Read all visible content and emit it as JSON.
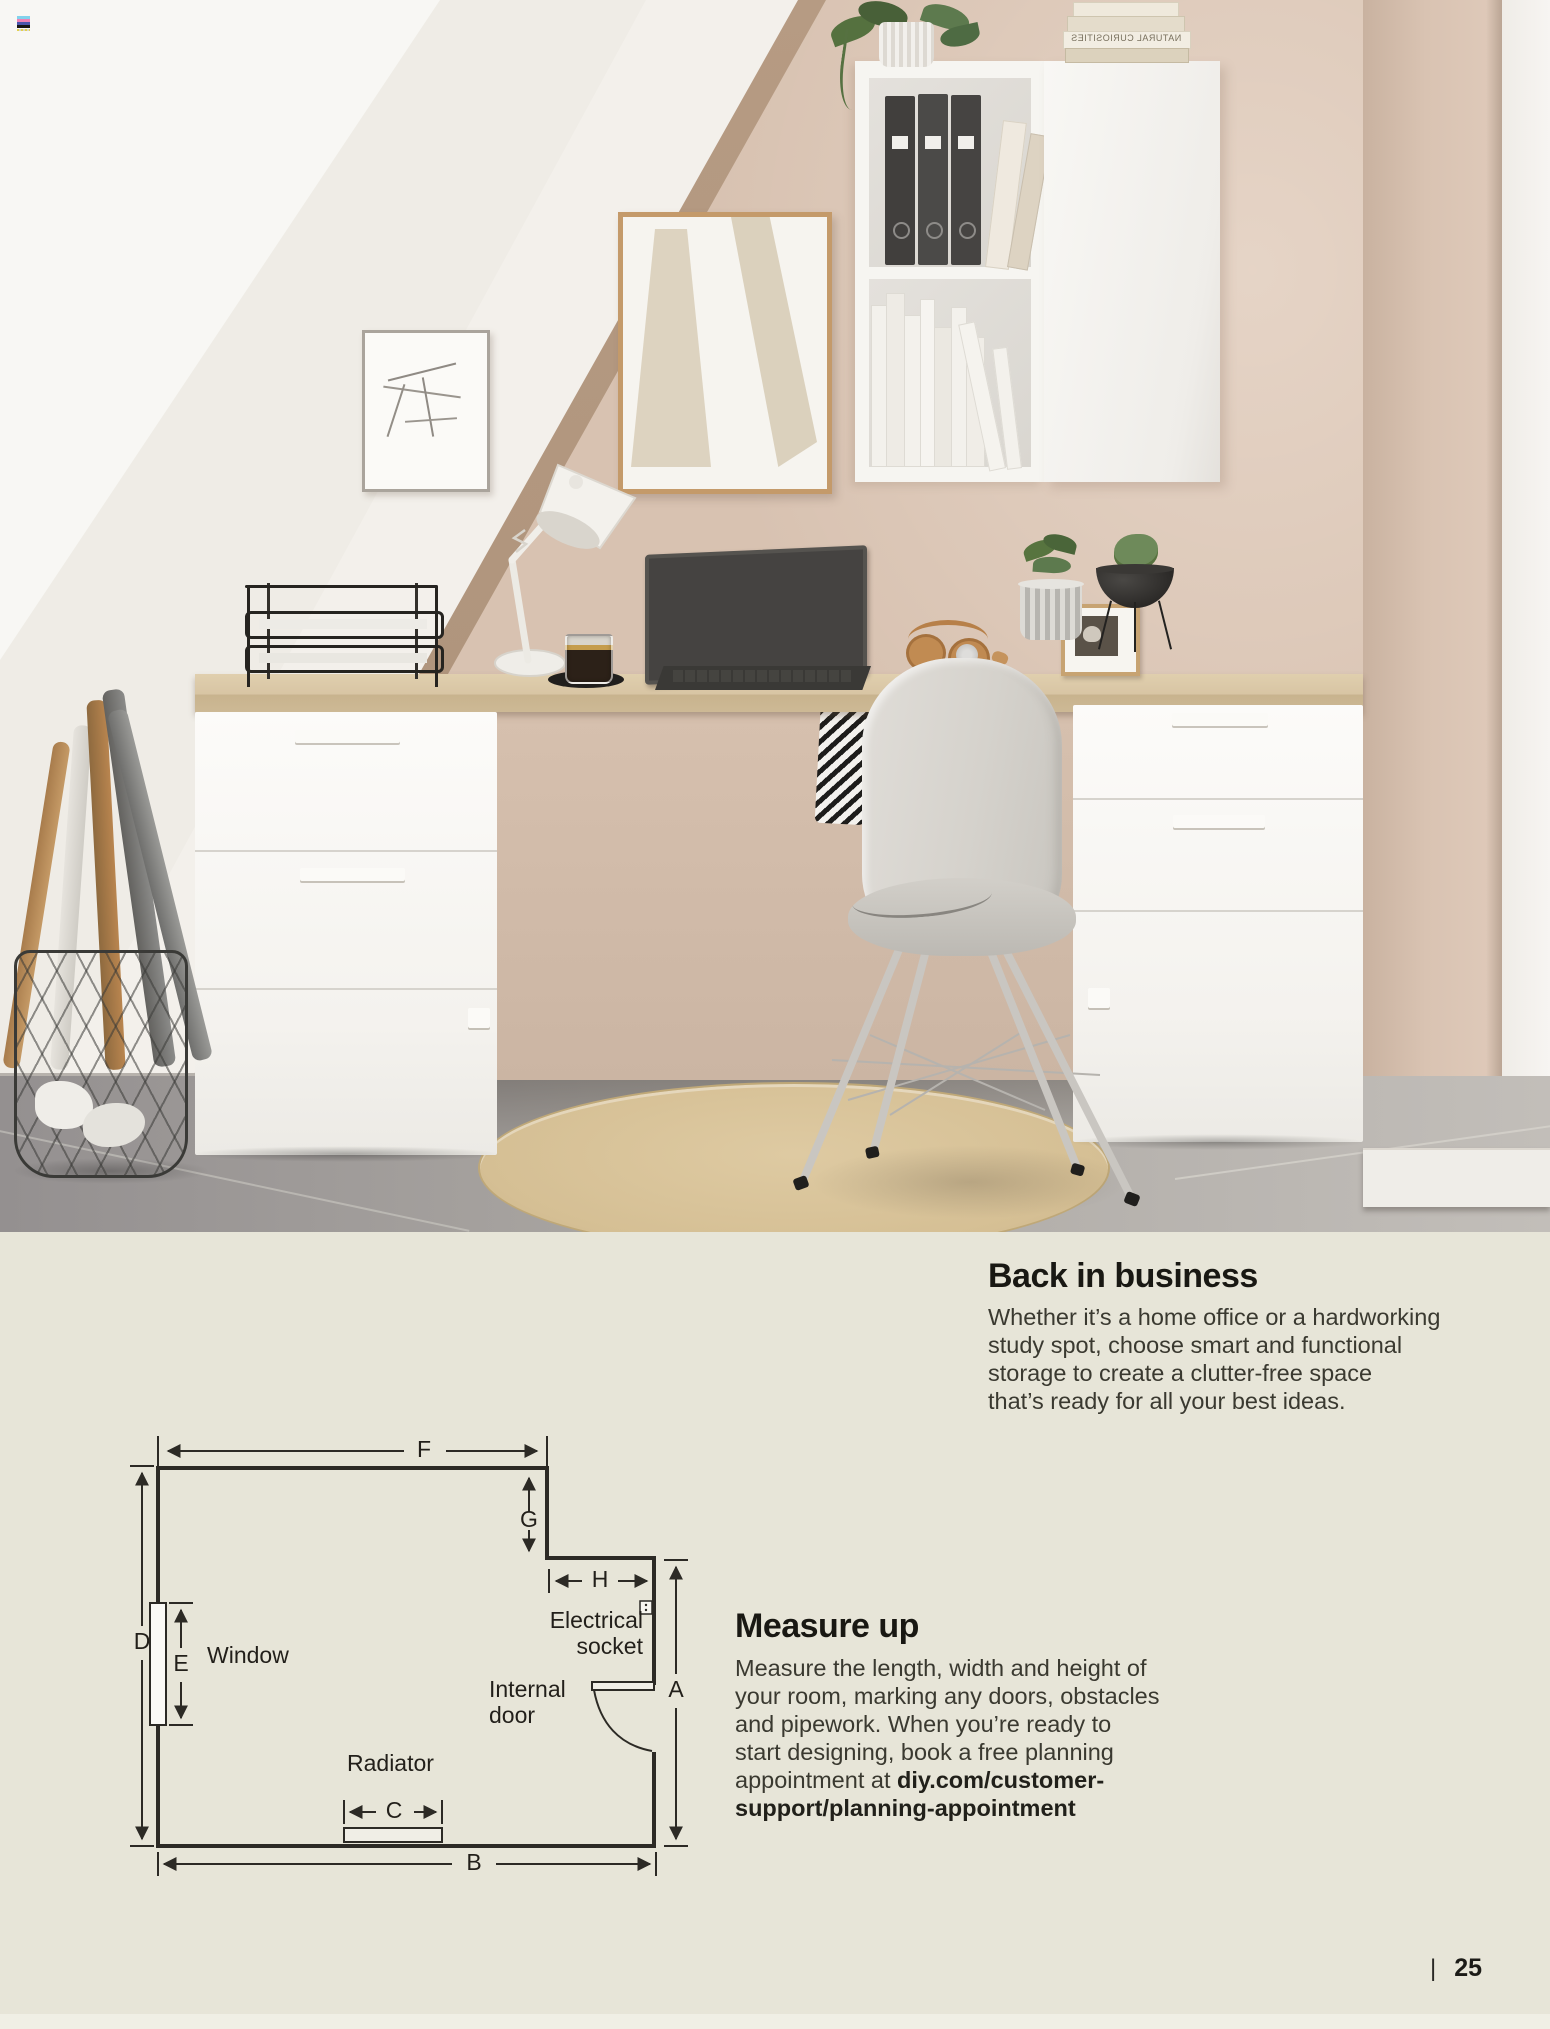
{
  "page": {
    "number": "25",
    "separator": "|"
  },
  "palette": {
    "panel_bg": "#e7e5d8",
    "wall_beige": "#d8c2b1",
    "stair_white": "#f1eee9",
    "desk_oak": "#d9c6a6",
    "floor_gray": "#a6a29e",
    "rug_sand": "#d7c196",
    "diagram_line": "#2c2a25",
    "text_dark": "#191813"
  },
  "photo": {
    "book_stack_title": "NATURAL CURIOSITIES"
  },
  "back_in_business": {
    "title": "Back in business",
    "lines": [
      "Whether it’s a home office or a hardworking",
      "study spot, choose smart and functional",
      "storage to create a clutter-free space",
      "that’s ready for all your best ideas."
    ]
  },
  "measure_up": {
    "title": "Measure up",
    "lines": [
      "Measure the length, width and height of",
      "your room, marking any doors, obstacles",
      "and pipework. When you’re ready to",
      "start designing, book a free planning"
    ],
    "line5_prefix": "appointment at ",
    "link_line1": "diy.com/customer-",
    "link_line2": "support/planning-appointment"
  },
  "diagram": {
    "labels": {
      "f": "F",
      "g": "G",
      "h": "H",
      "d": "D",
      "e": "E",
      "a": "A",
      "b": "B",
      "c": "C",
      "window": "Window",
      "electrical_line1": "Electrical",
      "electrical_line2": "socket",
      "internal_line1": "Internal",
      "internal_line2": "door",
      "radiator": "Radiator"
    }
  }
}
